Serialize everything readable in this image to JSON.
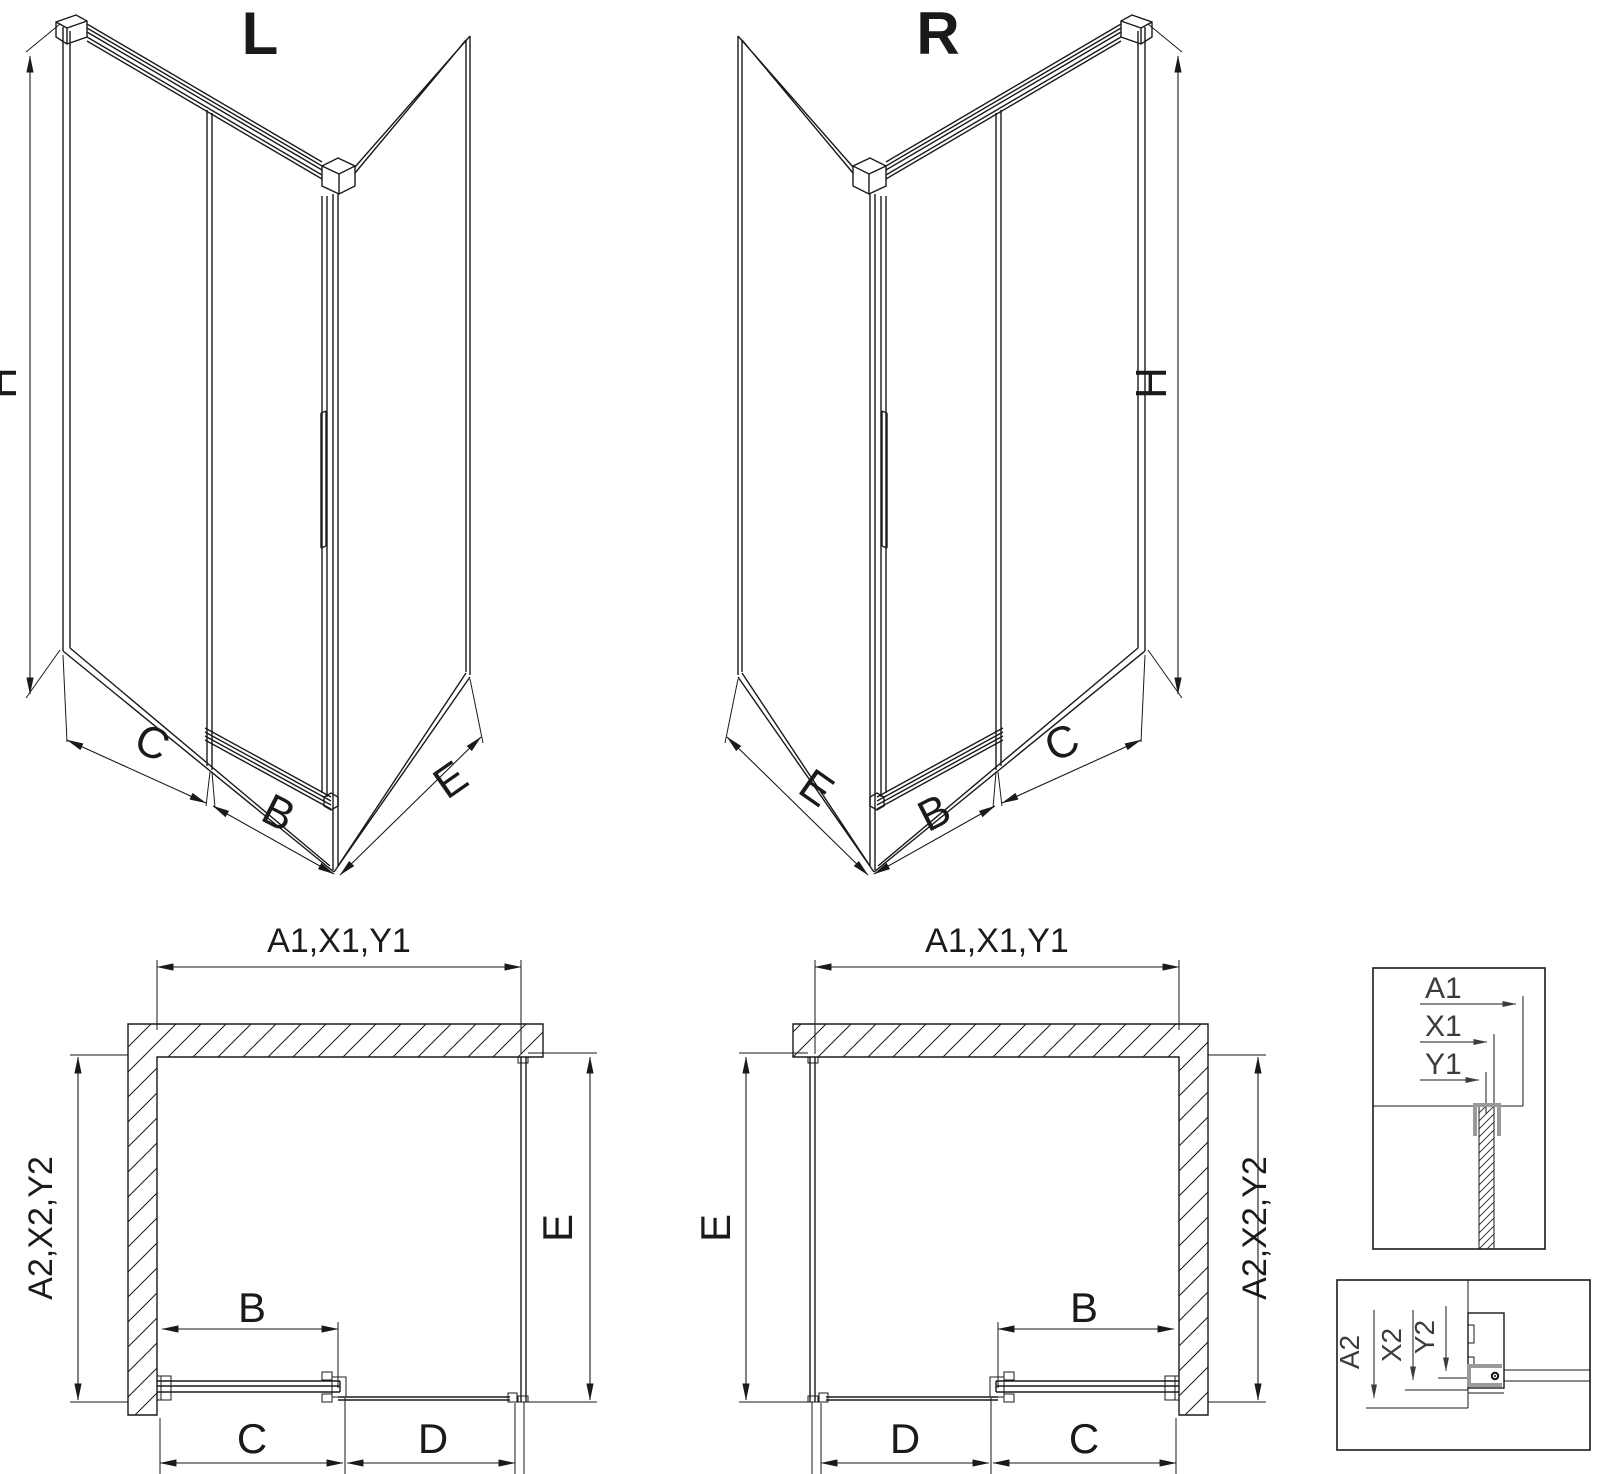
{
  "drawing": {
    "iso_left": {
      "title": "L",
      "height_label": "H",
      "panel_c_label": "C",
      "door_label": "B",
      "side_label": "E"
    },
    "iso_right": {
      "title": "R",
      "height_label": "H",
      "panel_c_label": "C",
      "door_label": "B",
      "side_label": "E"
    },
    "plan_left": {
      "width_labels": "A1,X1,Y1",
      "depth_labels": "A2,X2,Y2",
      "side_label": "E",
      "door_label": "B",
      "c_label": "C",
      "d_label": "D"
    },
    "plan_right": {
      "width_labels": "A1,X1,Y1",
      "depth_labels": "A2,X2,Y2",
      "side_label": "E",
      "door_label": "B",
      "c_label": "C",
      "d_label": "D"
    },
    "detail_width": {
      "labels": [
        "A1",
        "X1",
        "Y1"
      ]
    },
    "detail_depth": {
      "labels": [
        "A2",
        "X2",
        "Y2"
      ]
    },
    "colors": {
      "line": "#1a1a1a",
      "detail_text": "#3c3c3c",
      "hardware_gray": "#9a9a9a",
      "background": "#ffffff"
    }
  }
}
